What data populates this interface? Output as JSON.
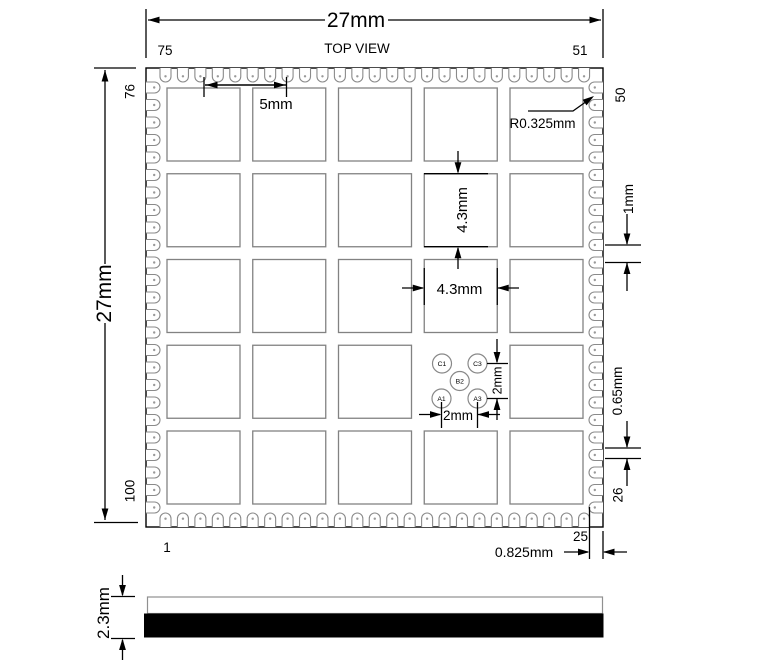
{
  "drawing": {
    "view_label": "TOP VIEW",
    "dims": {
      "overall_width": "27mm",
      "overall_height": "27mm",
      "pad_pitch": "5mm",
      "pad_height": "4.3mm",
      "pad_width": "4.3mm",
      "castellation_radius": "R0.325mm",
      "pin_pitch": "1mm",
      "pin_width": "0.65mm",
      "corner_offset": "0.825mm",
      "test_pad_pitch_vertical": "2mm",
      "test_pad_pitch_horizontal": "2mm",
      "module_thickness": "2.3mm"
    },
    "pin_labels": {
      "top_left": "75",
      "top_right": "51",
      "right_top": "50",
      "right_bottom": "26",
      "bottom_left": "1",
      "bottom_right": "25",
      "left_top": "76",
      "left_bottom": "100"
    },
    "pins_per_side": 25,
    "pad_grid": {
      "rows": 5,
      "cols": 5,
      "skip_cell": {
        "row": 3,
        "col": 3
      }
    },
    "test_pads": [
      {
        "label": "C1",
        "x": 442.0,
        "y": 363.5
      },
      {
        "label": "C3",
        "x": 477.5,
        "y": 363.5
      },
      {
        "label": "B2",
        "x": 459.75,
        "y": 381.0
      },
      {
        "label": "A1",
        "x": 441.5,
        "y": 398.5
      },
      {
        "label": "A3",
        "x": 477.5,
        "y": 398.5
      }
    ],
    "colors": {
      "line": "#000000",
      "pad_outline": "#828282",
      "castellation_outline": "#8a8a8a",
      "gray_text": "#808080"
    }
  }
}
